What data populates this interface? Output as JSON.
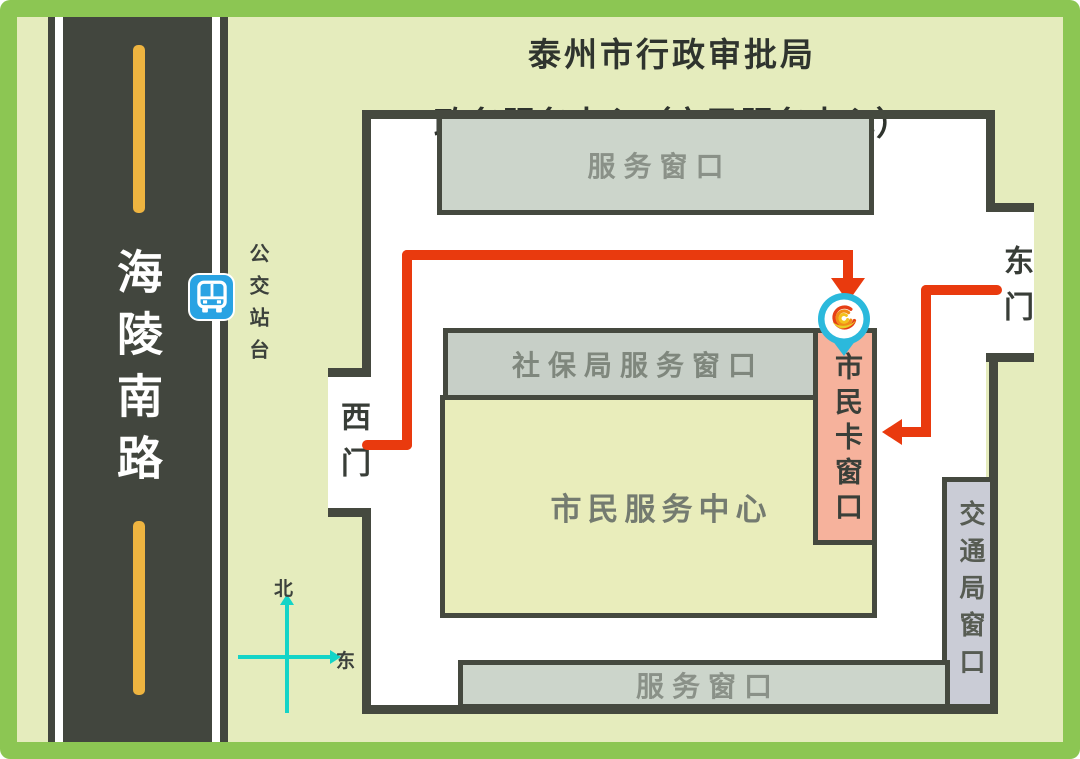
{
  "title": {
    "line1": "泰州市行政审批局",
    "line2": "政务服务中心（市民服务中心）"
  },
  "road": {
    "name": "海陵南路"
  },
  "bus_stop": {
    "label": "公交站台",
    "icon": "bus-icon"
  },
  "compass": {
    "north_label": "北",
    "east_label": "东"
  },
  "building": {
    "top_service_window": "服务窗口",
    "shebao_service_window": "社保局服务窗口",
    "citizen_service_center": "市民服务中心",
    "citizen_card_window": "市民卡窗口",
    "traffic_bureau_window": "交通局窗口",
    "bottom_service_window": "服务窗口",
    "west_gate": "西门",
    "east_gate": "东门"
  },
  "markers": {
    "destination_pin": "phoenix-logo-pin"
  },
  "colors": {
    "frame_green": "#8cc653",
    "background": "#e5ecbd",
    "road_asphalt": "#42463e",
    "lane_dash_yellow": "#eeb440",
    "wall_dark": "#45493f",
    "window_bar_fill": "#ccd5cb",
    "center_hall_fill": "#e9edbb",
    "citizen_card_fill": "#f6b29c",
    "traffic_window_fill": "#caccd6",
    "route_red": "#e93a0e",
    "compass_cyan": "#14d4c7",
    "bus_icon_blue": "#29a3e3",
    "pin_cyan": "#2bb9dc"
  }
}
